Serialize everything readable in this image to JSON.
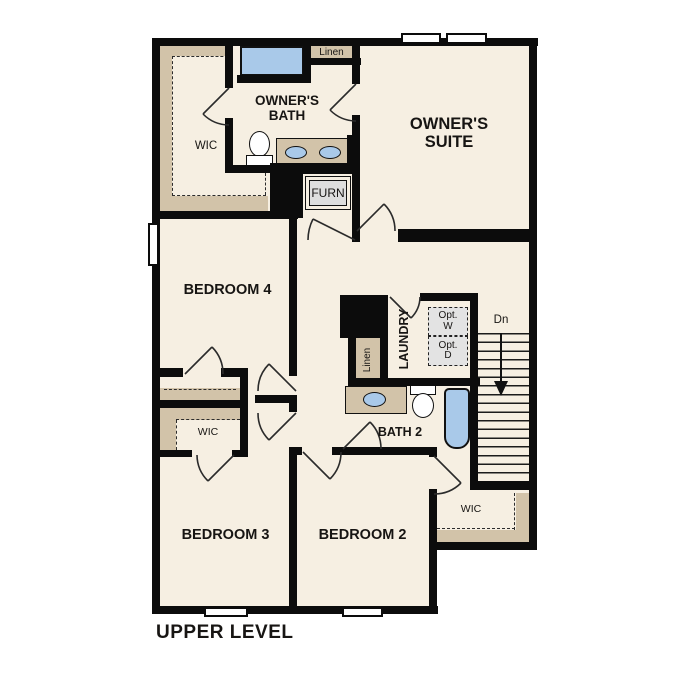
{
  "plan_title": "UPPER LEVEL",
  "colors": {
    "floor": "#f6efe2",
    "closet_shelf_tan": "#d2c3a9",
    "fixture_blue": "#a9c9e9",
    "wall_black": "#0c0c0c",
    "furnace_gray": "#dedede",
    "optional_appliance_gray": "#e3e3e3"
  },
  "rooms": {
    "owners_suite": {
      "label": "OWNER'S SUITE"
    },
    "owners_bath": {
      "label": "OWNER'S BATH"
    },
    "owners_wic": {
      "label": "WIC"
    },
    "bedroom4": {
      "label": "BEDROOM 4"
    },
    "bedroom3": {
      "label": "BEDROOM 3"
    },
    "bedroom2": {
      "label": "BEDROOM 2"
    },
    "bath2": {
      "label": "BATH 2"
    },
    "laundry": {
      "label": "LAUNDRY"
    },
    "bedroom3_wic": {
      "label": "WIC"
    },
    "bedroom2_wic": {
      "label": "WIC"
    }
  },
  "closets": {
    "linen_top": {
      "label": "Linen"
    },
    "linen_hall": {
      "label": "Linen"
    }
  },
  "annotations": {
    "furnace": {
      "label": "FURN"
    },
    "optional_washer": {
      "label": "Opt. W"
    },
    "optional_dryer": {
      "label": "Opt. D"
    },
    "stairs_down": {
      "label": "Dn"
    }
  }
}
